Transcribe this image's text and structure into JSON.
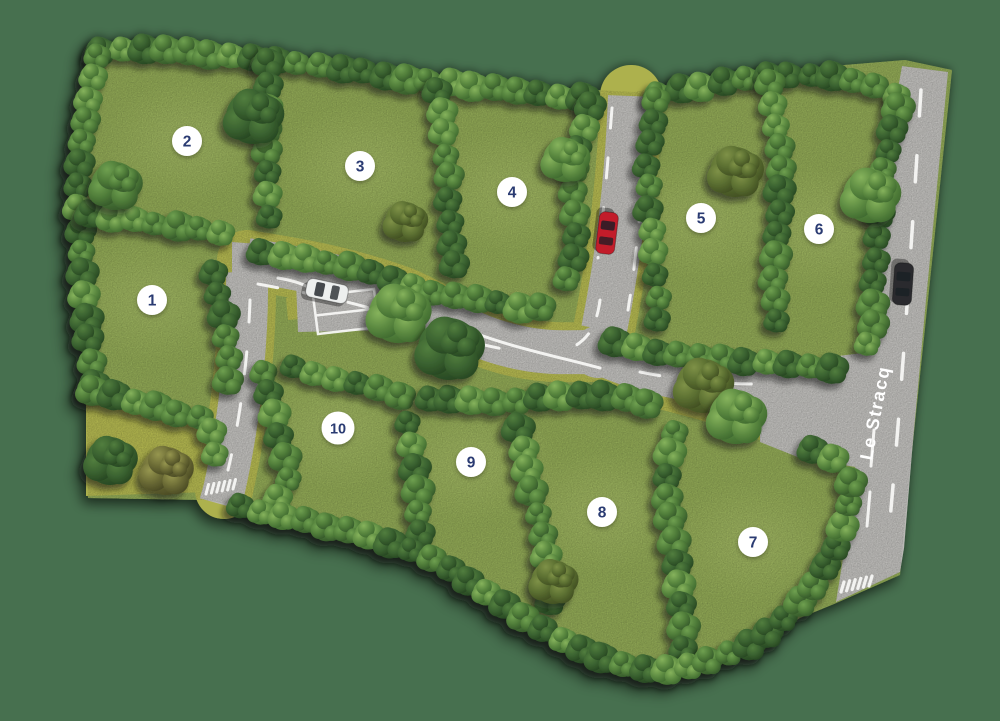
{
  "map": {
    "street_label": "Le Stracq",
    "colors": {
      "background": "#47704f",
      "grass": "#8ca353",
      "verge": "#adb14d",
      "road": "#bab9b6",
      "road_marking": "#f7f7f5",
      "marker_bg": "#ffffff",
      "marker_text": "#2b3a72",
      "street_label_text": "#ffffff"
    },
    "plots": [
      {
        "label": "1",
        "x": 152,
        "y": 300
      },
      {
        "label": "2",
        "x": 187,
        "y": 141
      },
      {
        "label": "3",
        "x": 360,
        "y": 166
      },
      {
        "label": "4",
        "x": 512,
        "y": 192
      },
      {
        "label": "5",
        "x": 701,
        "y": 218
      },
      {
        "label": "6",
        "x": 819,
        "y": 229
      },
      {
        "label": "7",
        "x": 753,
        "y": 542
      },
      {
        "label": "8",
        "x": 602,
        "y": 512
      },
      {
        "label": "9",
        "x": 471,
        "y": 462
      },
      {
        "label": "10",
        "x": 338,
        "y": 428
      }
    ],
    "cars": [
      {
        "name": "white-parked-car",
        "color": "#edefee",
        "x": 327,
        "y": 291,
        "angle": 12
      },
      {
        "name": "red-driving-car",
        "color": "#c21f2a",
        "x": 607,
        "y": 233,
        "angle": 97
      },
      {
        "name": "dark-driving-car",
        "color": "#2b2c2e",
        "x": 903,
        "y": 284,
        "angle": 94
      }
    ]
  }
}
